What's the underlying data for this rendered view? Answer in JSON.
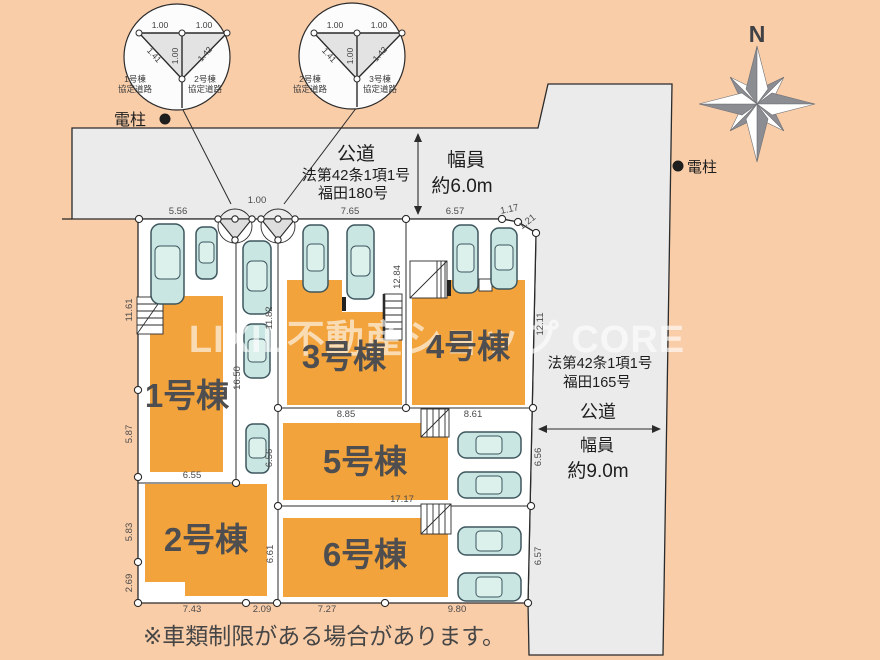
{
  "watermark": "LIXIL不動産ショップ CORE",
  "footnote": "※車類制限がある場合があります。",
  "compass": {
    "north": "N"
  },
  "poles": {
    "left": "電柱",
    "right": "電柱"
  },
  "roads": {
    "top": {
      "name": "公道",
      "law": "法第42条1項1号",
      "route": "福田180号",
      "width_label": "幅員",
      "width_value": "約6.0m"
    },
    "right": {
      "name": "公道",
      "law": "法第42条1項1号",
      "route": "福田165号",
      "width_label": "幅員",
      "width_value": "約9.0m"
    }
  },
  "buildings": [
    {
      "label": "1号棟"
    },
    {
      "label": "2号棟"
    },
    {
      "label": "3号棟"
    },
    {
      "label": "4号棟"
    },
    {
      "label": "5号棟"
    },
    {
      "label": "6号棟"
    }
  ],
  "detail_circles": [
    {
      "dim_top_left": "1.00",
      "dim_top_right": "1.00",
      "dim_left_diag": "1.41",
      "dim_center": "1.00",
      "dim_right_diag": "1.42",
      "label_left_1": "1号棟",
      "label_left_2": "協定道路",
      "label_right_1": "2号棟",
      "label_right_2": "協定道路"
    },
    {
      "dim_top_left": "1.00",
      "dim_top_right": "1.00",
      "dim_left_diag": "1.41",
      "dim_center": "1.00",
      "dim_right_diag": "1.42",
      "label_left_1": "2号棟",
      "label_left_2": "協定道路",
      "label_right_1": "3号棟",
      "label_right_2": "協定道路"
    }
  ],
  "dims": {
    "top": [
      "5.56",
      "1.00",
      "7.65",
      "6.57",
      "1.17",
      "1.21"
    ],
    "left": [
      "11.61",
      "5.87",
      "5.83",
      "2.69"
    ],
    "bottom": [
      "7.43",
      "2.09",
      "7.27",
      "9.80"
    ],
    "right": [
      "12.11",
      "6.56",
      "6.57"
    ],
    "inner": [
      "16.50",
      "11.82",
      "6.56",
      "6.61",
      "12.84",
      "6.55",
      "8.85",
      "8.61",
      "17.17"
    ]
  },
  "colors": {
    "background": "#FACDA9",
    "road": "#EBEBEB",
    "lot": "#FFFFFF",
    "building": "#F2A33C",
    "car": "#C9E6E2"
  }
}
